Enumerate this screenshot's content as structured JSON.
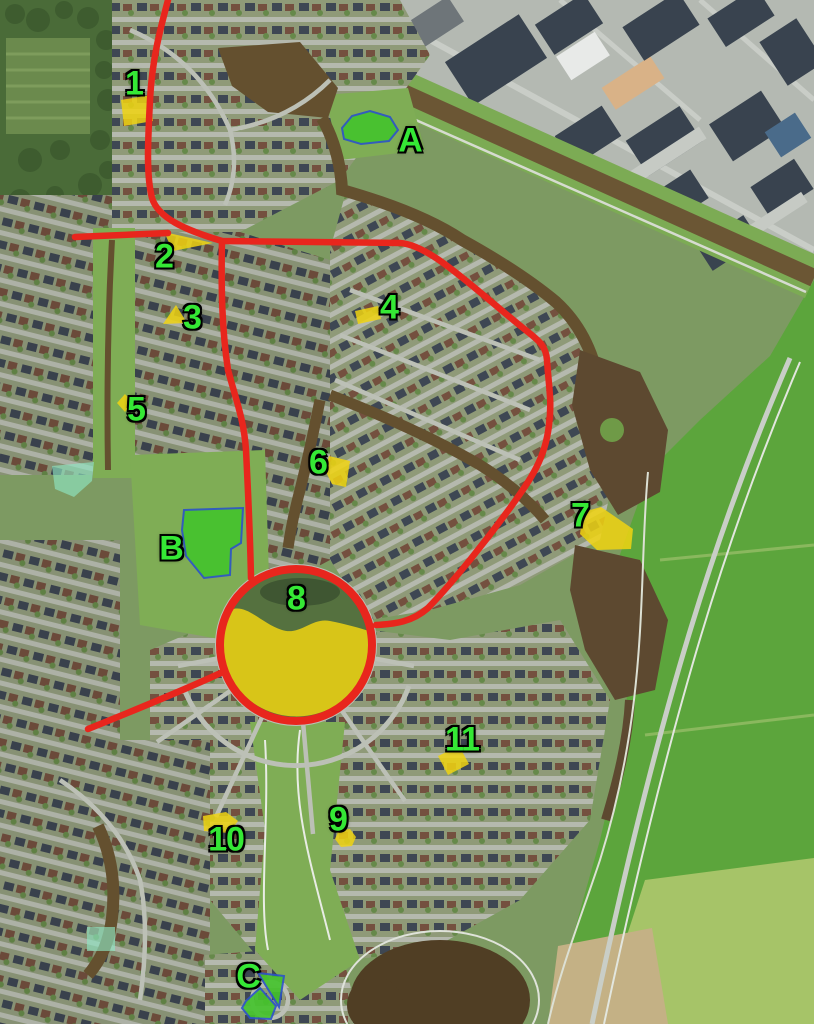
{
  "colors": {
    "route": "#e8261d",
    "highlight": "#f0d312",
    "area_green": "#44c42c",
    "area_border": "#2b54c8",
    "teal": "#8fe5c2",
    "label": "#35e835"
  },
  "markers": [
    {
      "label": "1",
      "x": 134,
      "y": 84
    },
    {
      "label": "2",
      "x": 164,
      "y": 257
    },
    {
      "label": "3",
      "x": 192,
      "y": 318
    },
    {
      "label": "4",
      "x": 389,
      "y": 308
    },
    {
      "label": "5",
      "x": 136,
      "y": 410
    },
    {
      "label": "6",
      "x": 318,
      "y": 463
    },
    {
      "label": "7",
      "x": 580,
      "y": 516
    },
    {
      "label": "8",
      "x": 296,
      "y": 599
    },
    {
      "label": "9",
      "x": 338,
      "y": 820
    },
    {
      "label": "10",
      "x": 226,
      "y": 840
    },
    {
      "label": "11",
      "x": 462,
      "y": 740
    },
    {
      "label": "A",
      "x": 410,
      "y": 141
    },
    {
      "label": "B",
      "x": 171,
      "y": 549
    },
    {
      "label": "C",
      "x": 248,
      "y": 977
    }
  ]
}
